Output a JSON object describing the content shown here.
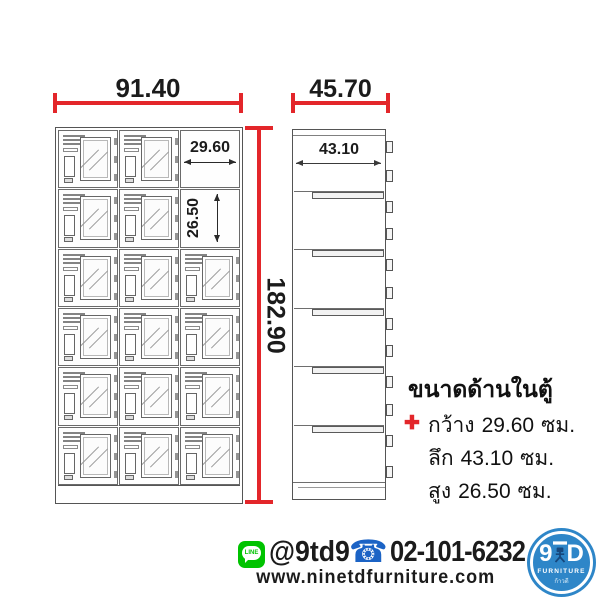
{
  "dimensions": {
    "front_width": "91.40",
    "depth": "45.70",
    "height": "182.90",
    "inner_width": "29.60",
    "inner_height": "26.50",
    "inner_depth": "43.10"
  },
  "front_view": {
    "rows": 6,
    "cols": 3
  },
  "spec_box": {
    "title": "ขนาดด้านในตู้",
    "bullet": "✚",
    "lines": [
      {
        "label": "กว้าง",
        "value": "29.60",
        "unit": "ซม."
      },
      {
        "label": "ลึก",
        "value": "43.10",
        "unit": "ซม."
      },
      {
        "label": "สูง",
        "value": "26.50",
        "unit": "ซม."
      }
    ]
  },
  "contact": {
    "line_badge": "LINE",
    "line_id": "@9td9",
    "phone_glyph": "☎",
    "phone": "02-101-6232",
    "website": "www.ninetdfurniture.com"
  },
  "logo": {
    "brand_left": "9",
    "brand_right": "D",
    "subtitle": "FURNITURE",
    "tagline": "ก้าวดี"
  },
  "colors": {
    "dimension_red": "#e3262a",
    "line_green": "#00c300",
    "phone_blue": "#1b63c5",
    "logo_blue": "#2e86c8"
  }
}
